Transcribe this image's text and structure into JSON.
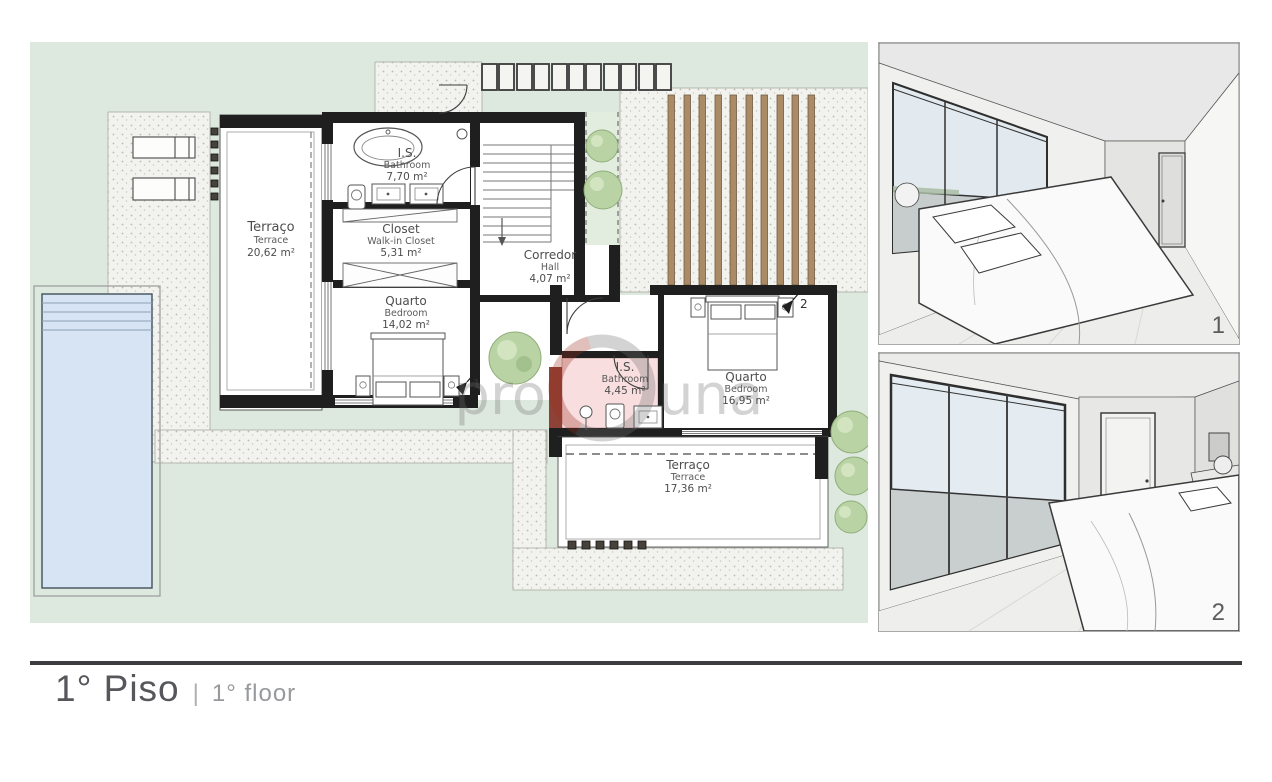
{
  "footer": {
    "title_pt": "1° Piso",
    "separator": "|",
    "title_en": "1° floor"
  },
  "plan": {
    "rooms": [
      {
        "id": "terrace1",
        "name_pt": "Terraço",
        "name_en": "Terrace",
        "area": "20,62 m²"
      },
      {
        "id": "bathroom1",
        "name_pt": "I.S.",
        "name_en": "Bathroom",
        "area": "7,70 m²"
      },
      {
        "id": "closet",
        "name_pt": "Closet",
        "name_en": "Walk-in Closet",
        "area": "5,31 m²"
      },
      {
        "id": "bedroom1",
        "name_pt": "Quarto",
        "name_en": "Bedroom",
        "area": "14,02 m²"
      },
      {
        "id": "hall",
        "name_pt": "Corredor",
        "name_en": "Hall",
        "area": "4,07 m²"
      },
      {
        "id": "bathroom2",
        "name_pt": "I.S.",
        "name_en": "Bathroom",
        "area": "4,45 m²"
      },
      {
        "id": "bedroom2",
        "name_pt": "Quarto",
        "name_en": "Bedroom",
        "area": "16,95 m²"
      },
      {
        "id": "terrace2",
        "name_pt": "Terraço",
        "name_en": "Terrace",
        "area": "17,36 m²"
      }
    ],
    "camera_markers": [
      {
        "label": "1"
      },
      {
        "label": "2"
      }
    ]
  },
  "renders": [
    {
      "label": "1"
    },
    {
      "label": "2"
    }
  ],
  "watermark": {
    "left": "pro",
    "right": "una"
  },
  "colors": {
    "yard_green": "#dde9de",
    "wall_black": "#1f1f1f",
    "pool_blue": "#d7e4f3",
    "bathroom_highlight": "#f8dede",
    "accent_red": "#8d4137",
    "wood_slat": "#ab8a66",
    "title_gray": "#56575b"
  }
}
